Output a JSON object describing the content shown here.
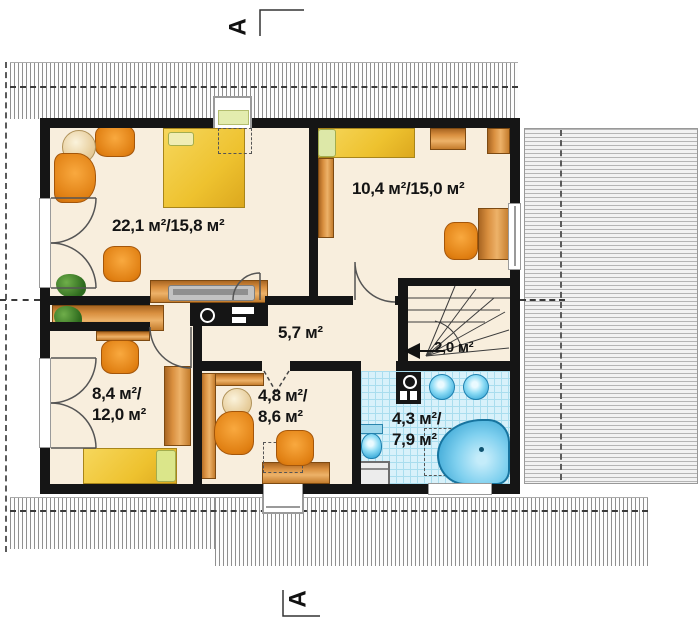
{
  "section_markers": {
    "top_label": "A",
    "bottom_label": "A"
  },
  "room_labels": {
    "bedroom_large": "22,1 м²/15,8 м²",
    "bedroom_right": "10,4 м²/15,0 м²",
    "hall": "5,7 м²",
    "stairs": "2,0 м²",
    "bedroom_small_line1": "8,4 м²/",
    "bedroom_small_line2": "12,0 м²",
    "study_line1": "4,8 м²/",
    "study_line2": "8,6 м²",
    "bathroom_line1": "4,3 м²/",
    "bathroom_line2": "7,9 м²"
  },
  "colors": {
    "wall": "#151515",
    "floor": "#f8eedd",
    "tile_blue": "#d8f1fa",
    "furniture_orange": "#ef8f1f",
    "wood_brown": "#d98f3f",
    "bed_yellow": "#eec22f",
    "pillow_green": "#dbe68a",
    "fixture_blue": "#55bfe6",
    "plant_green": "#2e6b1e",
    "hatch_gray": "#8f8f8f"
  }
}
